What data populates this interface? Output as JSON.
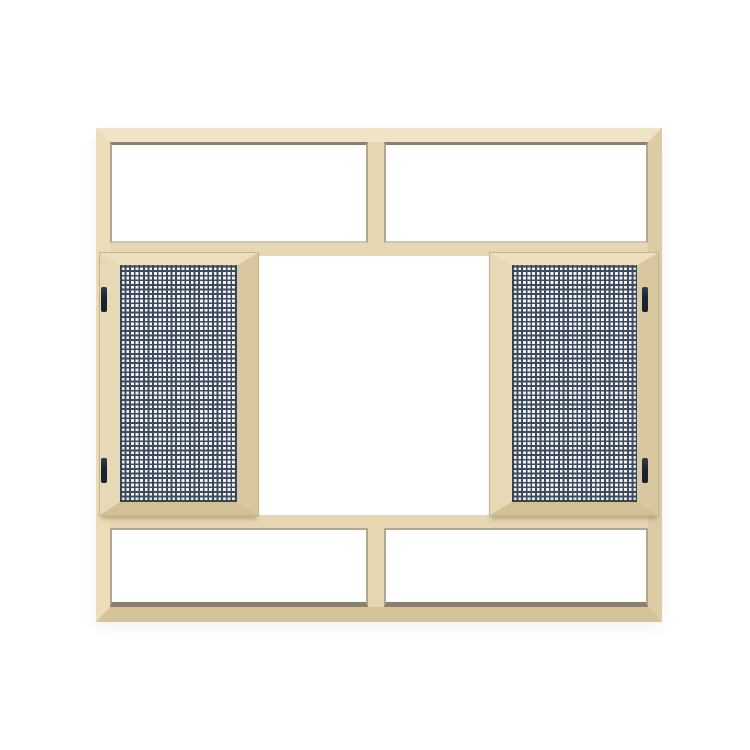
{
  "scene": {
    "description": "Product photograph of a cream-beige aluminium window unit on a white background: a fixed transom band with two clear panes across the top, a matching two-pane band across the bottom, and a middle section with two hinged fly-screen mesh panels on the left and right flanking an open white center pane. Each mesh panel has two dark hinges on its outer edge.",
    "background_color": "#ffffff"
  },
  "parts": {
    "frame": "beige aluminium outer frame with mitered corners",
    "top_transom_panes": 2,
    "bottom_transom_panes": 2,
    "screen_panels": 2,
    "screen_panel_sides": [
      "left",
      "right"
    ],
    "hinges_total": 4,
    "hinges_per_panel": 2,
    "center_pane": "open (white)",
    "mesh": "dark blue-grey woven insect screen grid"
  },
  "theme": {
    "bg": "#ffffff",
    "frame_face": "#e6d6b1",
    "frame_light": "#f0e4c6",
    "frame_left": "#ebdcba",
    "frame_right": "#dccba3",
    "frame_bottom": "#d5c39a",
    "sash_top": "#eddfbf",
    "sash_left_c": "#e8d9b6",
    "sash_right_c": "#d9c89f",
    "sash_bottom": "#d2c096",
    "seam": "#c6b48c",
    "groove_dark": "#8b8070",
    "groove_mid": "#b0a692",
    "groove_light": "#cfc5ad",
    "mesh_dark": "#3d4a5e",
    "mesh_light": "#f3f5f7",
    "hinge_dark": "#1a2230",
    "hinge_mid": "#303b4a"
  }
}
